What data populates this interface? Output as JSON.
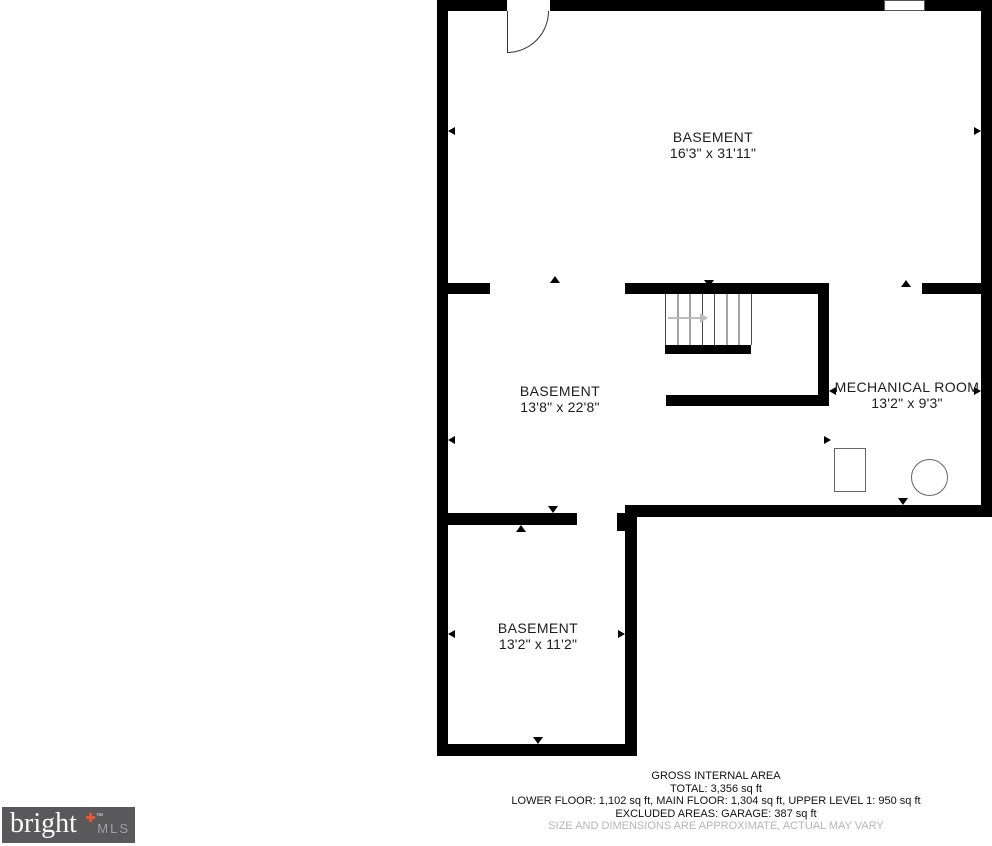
{
  "floorplan": {
    "rooms": [
      {
        "name": "BASEMENT",
        "dims": "16'3\" x 31'11\""
      },
      {
        "name": "BASEMENT",
        "dims": "13'8\" x 22'8\""
      },
      {
        "name": "MECHANICAL ROOM",
        "dims": "13'2\" x 9'3\""
      },
      {
        "name": "BASEMENT",
        "dims": "13'2\" x 11'2\""
      }
    ]
  },
  "footer": {
    "title": "GROSS INTERNAL AREA",
    "total": "TOTAL: 3,356 sq ft",
    "floors": "LOWER FLOOR: 1,102 sq ft, MAIN FLOOR: 1,304 sq ft, UPPER LEVEL 1: 950 sq ft",
    "excluded": "EXCLUDED AREAS: GARAGE: 387 sq ft",
    "disclaimer": "SIZE AND DIMENSIONS ARE APPROXIMATE, ACTUAL MAY VARY"
  },
  "logo": {
    "brand": "bright",
    "tm": "™",
    "suffix": "MLS"
  },
  "colors": {
    "wall": "#000000",
    "disclaimer_text": "#b5b5b5",
    "logo_background": "#59595b",
    "logo_accent": "#e8552f"
  }
}
